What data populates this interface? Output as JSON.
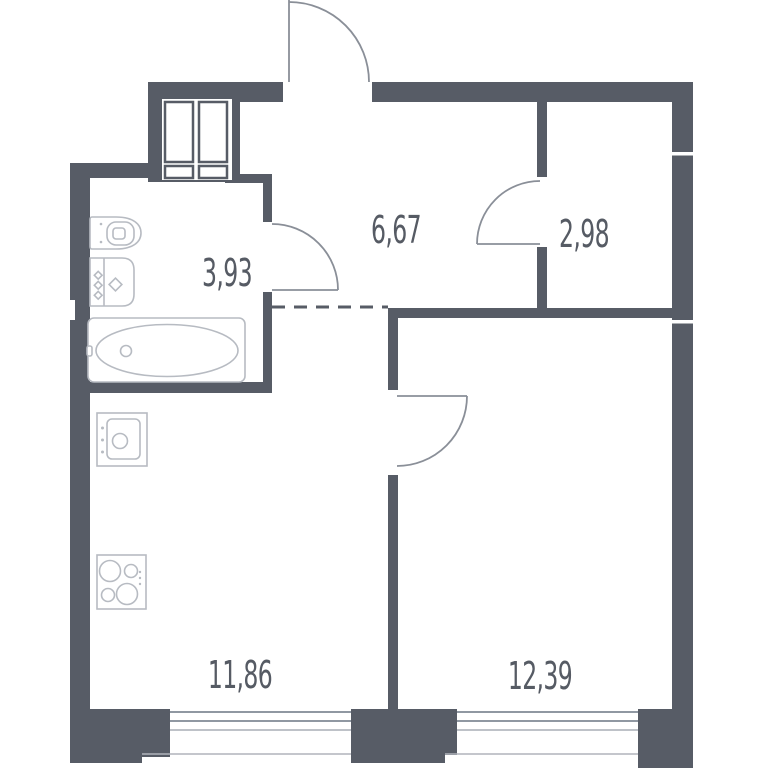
{
  "floor_plan": {
    "kind": "apartment-floor-plan",
    "background_color": "#FFFFFF",
    "colors": {
      "wall": "#575C66",
      "fixture_line": "#B7BBC2",
      "door_line": "#8A8F98",
      "window_line": "#9098A2",
      "label_text": "#565B64"
    },
    "rooms": [
      {
        "name": "hallway",
        "area": "6,67"
      },
      {
        "name": "wardrobe",
        "area": "2,98"
      },
      {
        "name": "bathroom",
        "area": "3,93"
      },
      {
        "name": "kitchen-living-room",
        "area": "11,86"
      },
      {
        "name": "bedroom",
        "area": "12,39"
      }
    ],
    "fixtures": [
      "toilet",
      "washbasin",
      "bathtub",
      "kitchen-sink",
      "stove-4-burners",
      "ventilation-shaft"
    ],
    "doors": [
      "entrance-door-swing-out-top",
      "bathroom-door",
      "wardrobe-door",
      "bedroom-door"
    ],
    "windows": [
      "kitchen-living-room-window",
      "bedroom-window"
    ],
    "open_plan_boundary": "dashed-line-between-hallway-and-kitchen"
  }
}
